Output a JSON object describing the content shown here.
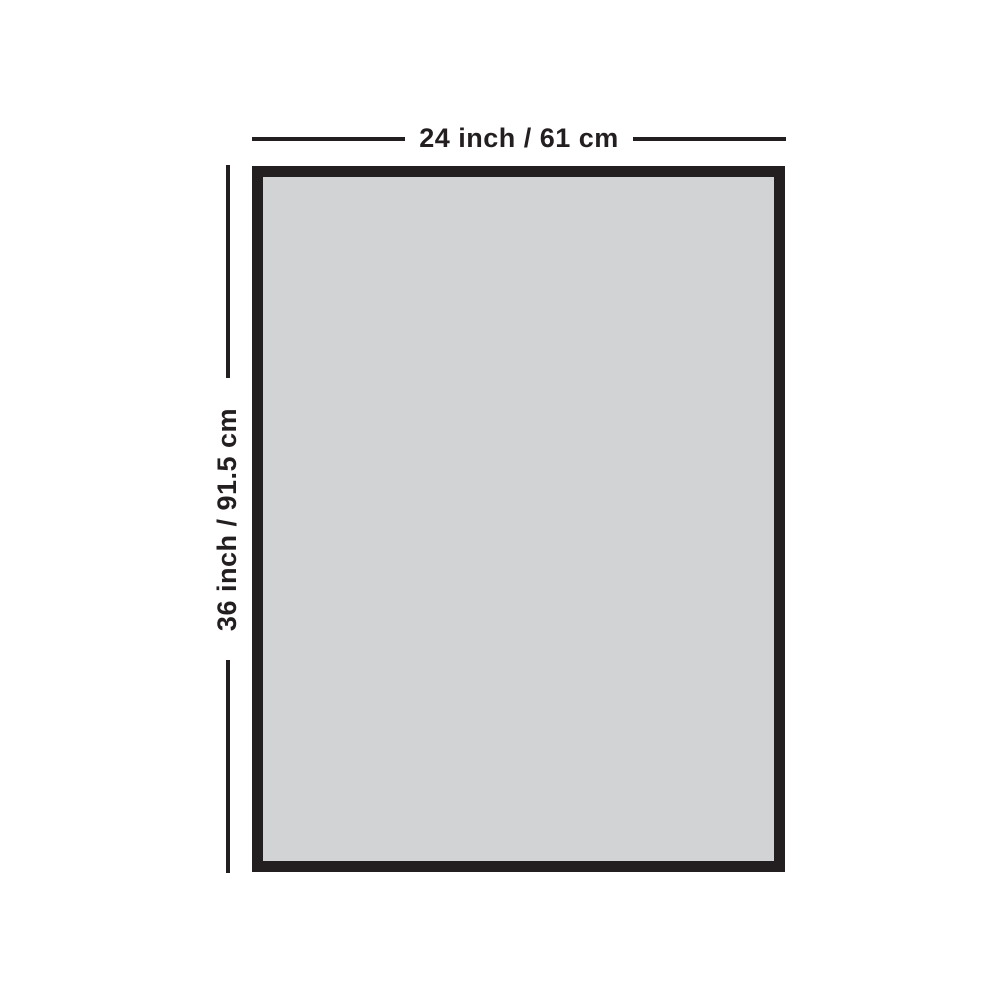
{
  "diagram": {
    "type": "product-dimension-diagram",
    "width_label": "24 inch / 61 cm",
    "height_label": "36 inch / 91.5 cm",
    "colors": {
      "background": "#ffffff",
      "rectangle_fill": "#d1d3d4",
      "rectangle_border": "#231f20",
      "dimension_line": "#231f20",
      "label_text": "#231f20"
    }
  }
}
